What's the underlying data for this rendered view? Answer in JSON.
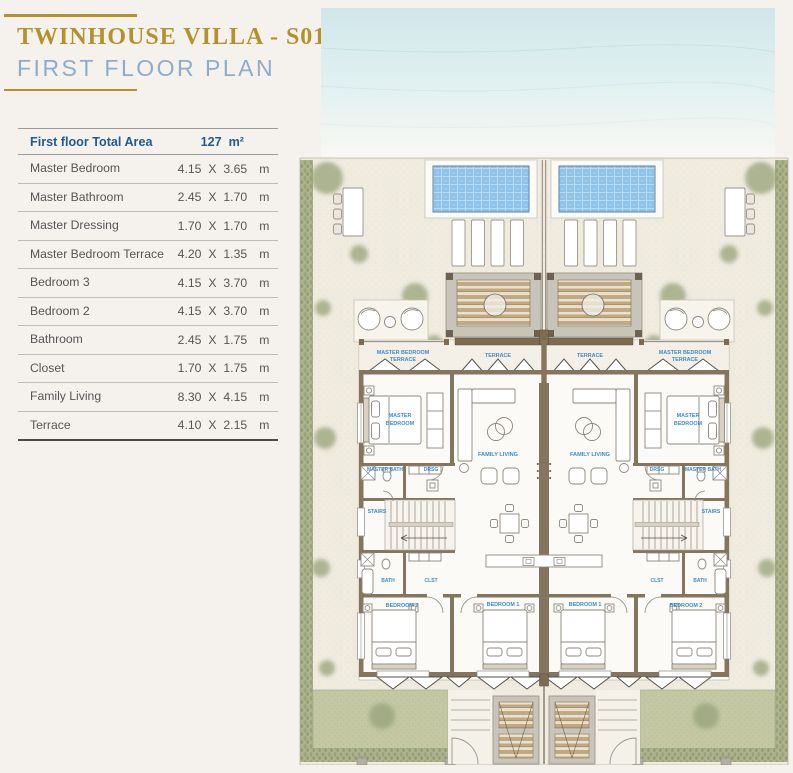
{
  "page": {
    "background": "#f5f2ee"
  },
  "header": {
    "title_line1": "TWINHOUSE VILLA - S01",
    "title_line2": "FIRST FLOOR PLAN",
    "accent_gold": "#b3922e",
    "subtitle_blue": "#8cadca"
  },
  "area_table": {
    "header_label": "First floor Total Area",
    "total_value": "127",
    "total_unit": "m²",
    "dim_sep": "X",
    "header_color": "#1f5c8d",
    "rows": [
      {
        "name": "Master Bedroom",
        "w": "4.15",
        "h": "3.65",
        "unit": "m"
      },
      {
        "name": "Master Bathroom",
        "w": "2.45",
        "h": "1.70",
        "unit": "m"
      },
      {
        "name": "Master Dressing",
        "w": "1.70",
        "h": "1.70",
        "unit": "m"
      },
      {
        "name": "Master Bedroom Terrace",
        "w": "4.20",
        "h": "1.35",
        "unit": "m"
      },
      {
        "name": "Bedroom 3",
        "w": "4.15",
        "h": "3.70",
        "unit": "m"
      },
      {
        "name": "Bedroom 2",
        "w": "4.15",
        "h": "3.70",
        "unit": "m"
      },
      {
        "name": "Bathroom",
        "w": "2.45",
        "h": "1.75",
        "unit": "m"
      },
      {
        "name": "Closet",
        "w": "1.70",
        "h": "1.75",
        "unit": "m"
      },
      {
        "name": "Family Living",
        "w": "8.30",
        "h": "4.15",
        "unit": "m"
      },
      {
        "name": "Terrace",
        "w": "4.10",
        "h": "2.15",
        "unit": "m"
      }
    ]
  },
  "floor_plan": {
    "labels": {
      "master_bedroom_terrace_line1": "MASTER BEDROOM",
      "master_bedroom_terrace_line2": "TERRACE",
      "terrace": "TERRACE",
      "master_bedroom_line1": "MASTER",
      "master_bedroom_line2": "BEDROOM",
      "family_living": "FAMILY LIVING",
      "master_bath": "MASTER BATH",
      "dressing": "DRSG",
      "stairs": "STAIRS",
      "bath": "BATH",
      "closet": "CLST",
      "bedroom2": "BEDROOM 2",
      "bedroom1": "BEDROOM 1"
    },
    "colors": {
      "label_blue": "#3e8cc7",
      "wall": "#84755e",
      "pool_water": "#8fc3e9",
      "lawn_green": "#c1c7a2",
      "hedge_green": "#a9b18c",
      "sea": "#d5eaec",
      "sand": "#f0ebdf",
      "wood_deck": "#c3a87c",
      "concrete": "#c9c4ba"
    }
  }
}
